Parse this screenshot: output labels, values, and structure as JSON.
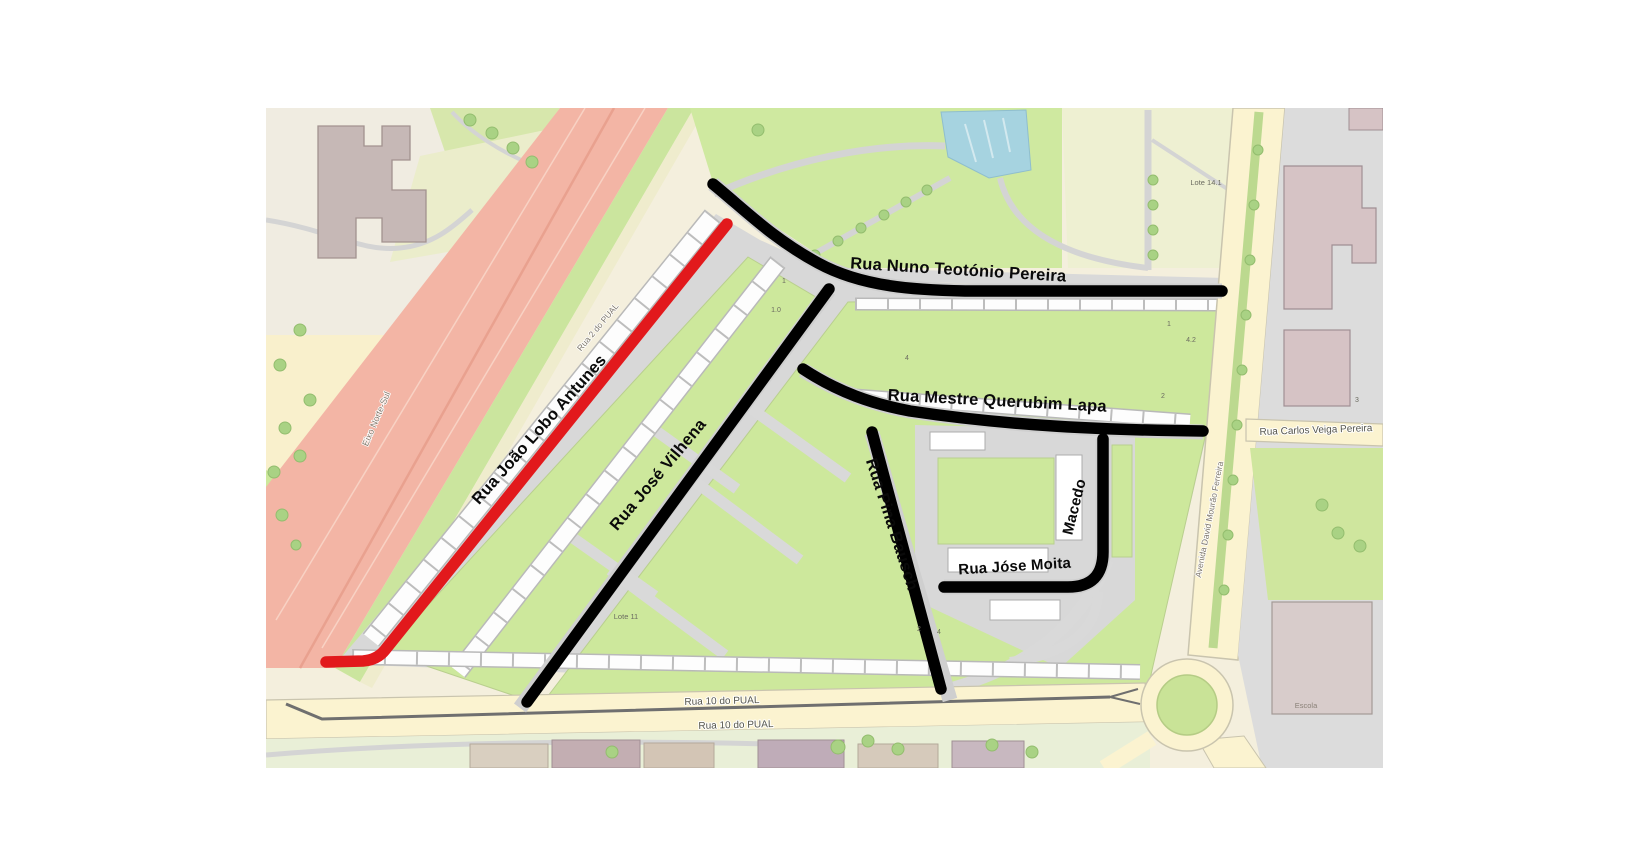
{
  "map": {
    "type": "street-map-with-route-annotations",
    "labels": {
      "rua_joao_lobo_antunes": "Rua João Lobo Antunes",
      "rua_nuno_teotonio_pereira": "Rua Nuno Teotónio Pereira",
      "rua_mestre_querubim_lapa": "Rua Mestre Querubim Lapa",
      "rua_jose_vilhena": "Rua José Vilhena",
      "rua_pina_bausch": "Rua Pina Bausch",
      "rua_jose_moita": "Rua Jóse Moita",
      "macedo": "Macedo",
      "eixo_norte_sul": "Eixo Norte-Sul",
      "rua_2_do_pual": "Rua 2 do PUAL",
      "rua_10_do_pual_upper": "Rua 10 do PUAL",
      "rua_10_do_pual_lower": "Rua 10 do PUAL",
      "rua_carlos_veiga_pereira": "Rua Carlos Veiga Pereira",
      "avenida_david_mourao_ferreira": "Avenida David Mourão Ferreira",
      "lote_14_1": "Lote 14.1",
      "lote_11": "Lote 11",
      "escola": "Escola",
      "numbers": {
        "n1": "1",
        "n2": "1.0",
        "n3": "1",
        "n4": "4.2",
        "n5": "2",
        "n6": "3",
        "n7": "4",
        "n8": "2",
        "n9": "4"
      }
    },
    "colors": {
      "highlight_red": "#e2191c",
      "highlight_black": "#000000",
      "water_blue": "#a6d3e0",
      "park_green": "#cfe9a0",
      "motorway_pink": "#f3b5a5"
    }
  }
}
